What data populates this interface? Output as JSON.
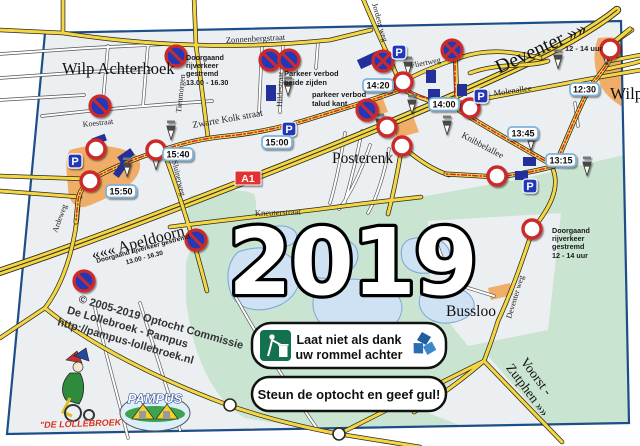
{
  "poster": {
    "year": "2019"
  },
  "places": {
    "wilp_achterhoek": "Wilp Achterhoek",
    "posterenk": "Posterenk",
    "deventer": "Deventer »»",
    "apeldoorn": "««« Apeldoorn",
    "wilp": "Wilp",
    "bussloo": "Bussloo",
    "voorst_1": "Voorst -",
    "voorst_2": "Zutphen »»"
  },
  "roads": {
    "zonnenbergstraat": "Zonnenbergstraat",
    "jordens_weg": "Jordens weg",
    "fliertweg": "Fliertweg",
    "molenallee": "Molenallee",
    "hildestraat": "Hildestraat",
    "tienmorgen": "Tienmorgen",
    "koestraat": "Koestraat",
    "zwarte_kolk": "Zwarte Kolk straat",
    "sluinerweg": "Sluinerweg",
    "ardeweg": "Ardeweg",
    "knibbelallee": "Knibbelallee",
    "kneuterstraat": "Kneuterstraat",
    "deventer_weg": "Deventer weg",
    "a1": "A1"
  },
  "times": {
    "t_uur": "12 - 14 uur",
    "t1230": "12:30",
    "t1315": "13:15",
    "t1345": "13:45",
    "t1400": "14:00",
    "t1420": "14:20",
    "t1500": "15:00",
    "t1540": "15:40",
    "t1550": "15:50"
  },
  "notices": {
    "north": {
      "l1": "Doorgaand",
      "l2": "rijverkeer",
      "l3": "gestremd",
      "l4": "13.00 - 16.30"
    },
    "parkeer_beide": {
      "l1": "Parkeer verbod",
      "l2": "beide zijden"
    },
    "parkeer_talud": {
      "l1": "parkeer verbod",
      "l2": "talud kant"
    },
    "south": {
      "l1": "Doorgaand rijverkeer gestremd",
      "l2": "13.00 - 16.30"
    },
    "east": {
      "l1": "Doorgaand",
      "l2": "rijverkeer",
      "l3": "gestremd",
      "l4": "12 - 14 uur"
    }
  },
  "banners": {
    "litter_l1": "Laat niet als dank",
    "litter_l2": "uw rommel achter",
    "support": "Steun de optocht en geef gul!"
  },
  "credits": {
    "l1": "© 2005-2019 Optocht Commissie",
    "l2": "De Lollebroek - Pampus",
    "l3": "http://pampus-lollebroek.nl"
  },
  "logos": {
    "lollebroek": "\"DE LOLLEBROEK\"",
    "pampus": "PAMPUS"
  },
  "icons": {
    "parking_label": "P"
  },
  "colors": {
    "border": "#1d4e89",
    "road_yellow": "#f4d645",
    "route_red": "#d62828",
    "green": "#c9e4d0",
    "lake": "#cfe2f4",
    "orange": "#f0ad67",
    "sign_blue": "#2438b8",
    "sign_red": "#cc2b2b",
    "a1_red": "#e23333"
  }
}
